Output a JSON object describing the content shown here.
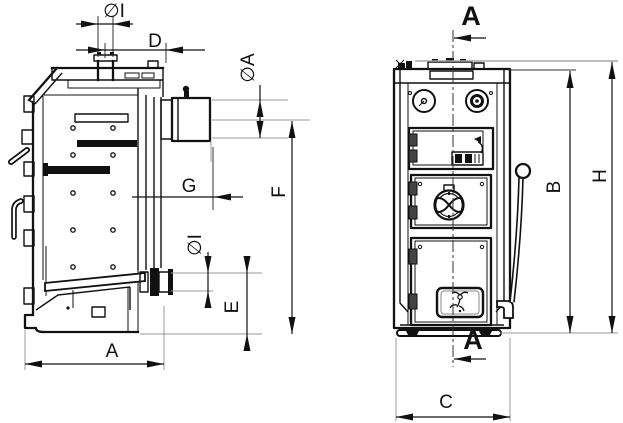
{
  "drawing": {
    "background": "#ffffff",
    "line_color": "#111111",
    "extension_line_color": "#999999",
    "left_view_dims": {
      "top_port_diameter": "∅I",
      "top_port_offset": "D",
      "flue_diameter": "∅A",
      "flue_axis_to_floor": "F",
      "flue_axis_offset": "G",
      "return_port_diameter": "∅I",
      "return_axis_to_floor": "E",
      "depth": "A"
    },
    "right_view_dims": {
      "body_height": "B",
      "overall_height": "H",
      "width": "C"
    },
    "section_marker": "A"
  }
}
